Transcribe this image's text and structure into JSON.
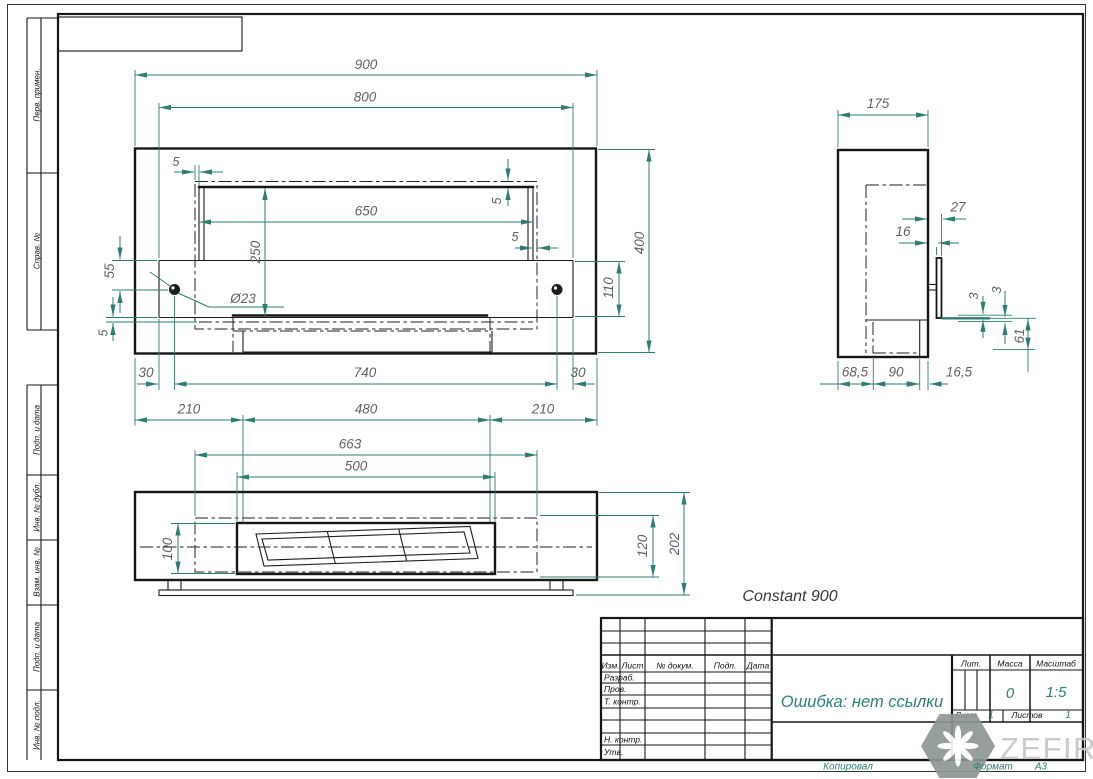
{
  "colors": {
    "dimension_lines": "#2e7d73",
    "dimension_text": "#5c6360",
    "geometry": "#161616",
    "accent_teal_text": "#2e8077",
    "watermark_gray": "#c3c8c7"
  },
  "product": {
    "name": "Constant 900"
  },
  "watermark": {
    "brand": "ZEFIRE"
  },
  "frame": {
    "top_labels": [
      "Перв. примен.",
      "Справ. №"
    ],
    "bottom_labels": [
      "Подп. и дата",
      "Инв. № дубл.",
      "Взам. инв. №",
      "Подп. и дата",
      "Инв. № подл."
    ],
    "footer": {
      "copied": "Копировал",
      "format_label": "Формат",
      "format_value": "А3"
    }
  },
  "title_block": {
    "doc_title": "Ошибка: нет ссылки",
    "cols": {
      "izm": "Изм.",
      "list": "Лист",
      "doc": "№ докум.",
      "podp": "Подп.",
      "date": "Дата"
    },
    "rows": {
      "razrab": "Разраб.",
      "prov": "Пров.",
      "tkontr": "Т. контр.",
      "nkontr": "Н. контр.",
      "utv": "Утв."
    },
    "lit_label": "Лит.",
    "mass_label": "Масса",
    "scale_label": "Масштаб",
    "mass_value": "0",
    "scale_value": "1:5",
    "sheet_label": "Лист",
    "sheet_value": "1",
    "sheets_label": "Листов",
    "sheets_value": "1"
  },
  "dims": {
    "front": {
      "overall_w": "900",
      "inner_w": "800",
      "slot_w": "650",
      "overall_h": "400",
      "window_h": "250",
      "band_h": "110",
      "hole_offset": "55",
      "gap_tl": "5",
      "gap_tr": "5",
      "gap_r": "5",
      "gap_bl": "5",
      "hole_dia": "Ø23",
      "edge_l": "30",
      "holes_span": "740",
      "edge_r": "30",
      "leg_l": "210",
      "mid_span": "480",
      "leg_r": "210"
    },
    "plan": {
      "insert_w": "663",
      "slot_w": "500",
      "slot_d": "100",
      "insert_d": "120",
      "overall_d": "202"
    },
    "side": {
      "depth": "175",
      "lip_a": "27",
      "lip_b": "16",
      "gap_a": "3",
      "gap_b": "3",
      "drop": "61",
      "seg_a": "68,5",
      "seg_b": "90",
      "seg_c": "16,5"
    }
  }
}
